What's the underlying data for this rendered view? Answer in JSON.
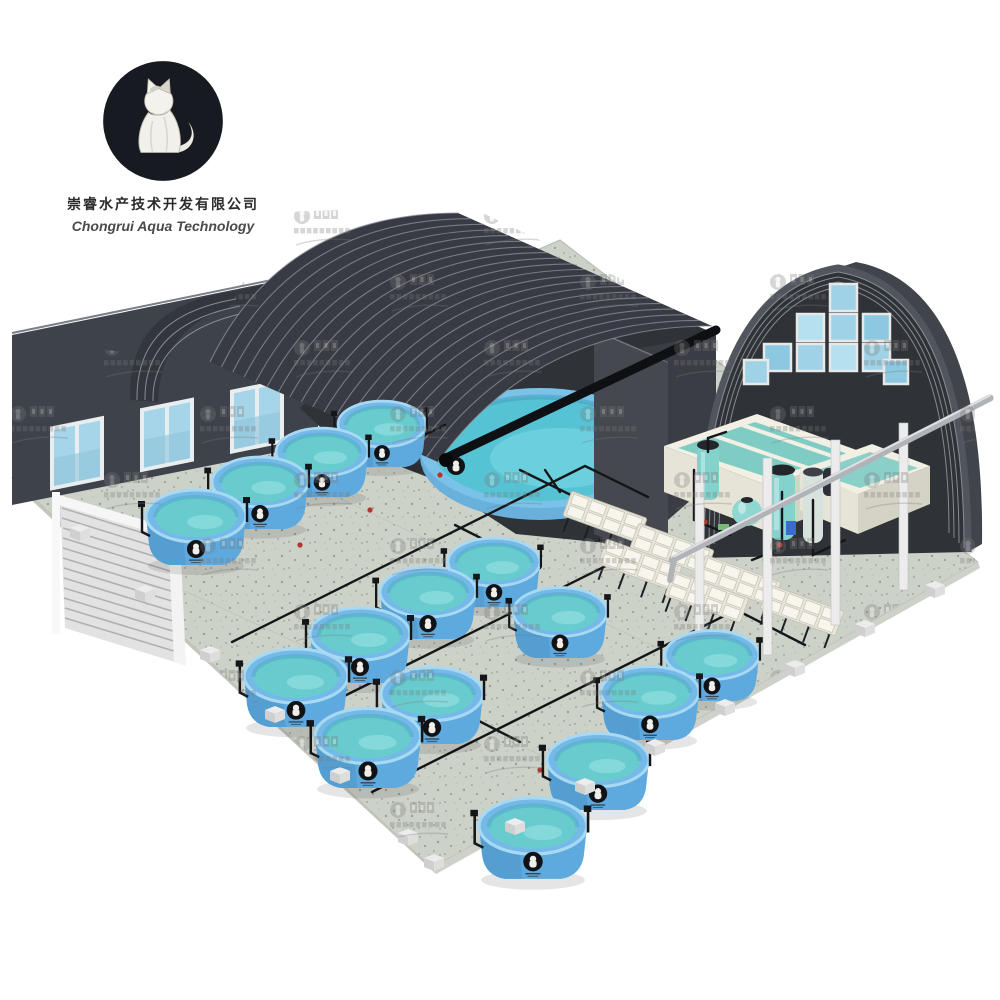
{
  "company": {
    "logo_icon": "cat-logo",
    "name_cn": "崇睿水产技术开发有限公司",
    "name_en": "Chongrui Aqua Technology"
  },
  "watermark": {
    "icon": "cat-logo-watermark",
    "text_cn": "崇睿水产技术开发有限公司",
    "text_en": "Chongrui Aqua Technology"
  },
  "scene": {
    "subject": "aquaculture-greenhouse-facility-render",
    "counts": {
      "round_fish_tanks": 15,
      "large_round_pool": 1,
      "filter_vessels": 5,
      "hatchery_tray_racks": 6,
      "sump_tanks": 2,
      "greenhouse_tunnels": 3,
      "wall_windows": 5
    },
    "colors": {
      "background": "#ffffff",
      "roof_dark": "#383b43",
      "wall_dark": "#3e424a",
      "floor_concrete": "#cdd2c9",
      "tank_blue": "#74b9e7",
      "water_teal": "#68ccce",
      "window_blue": "#a6d4e8",
      "equipment_teal": "#84d2cc",
      "sump_cream": "#ece9db",
      "pipe_black": "#14161a"
    }
  }
}
